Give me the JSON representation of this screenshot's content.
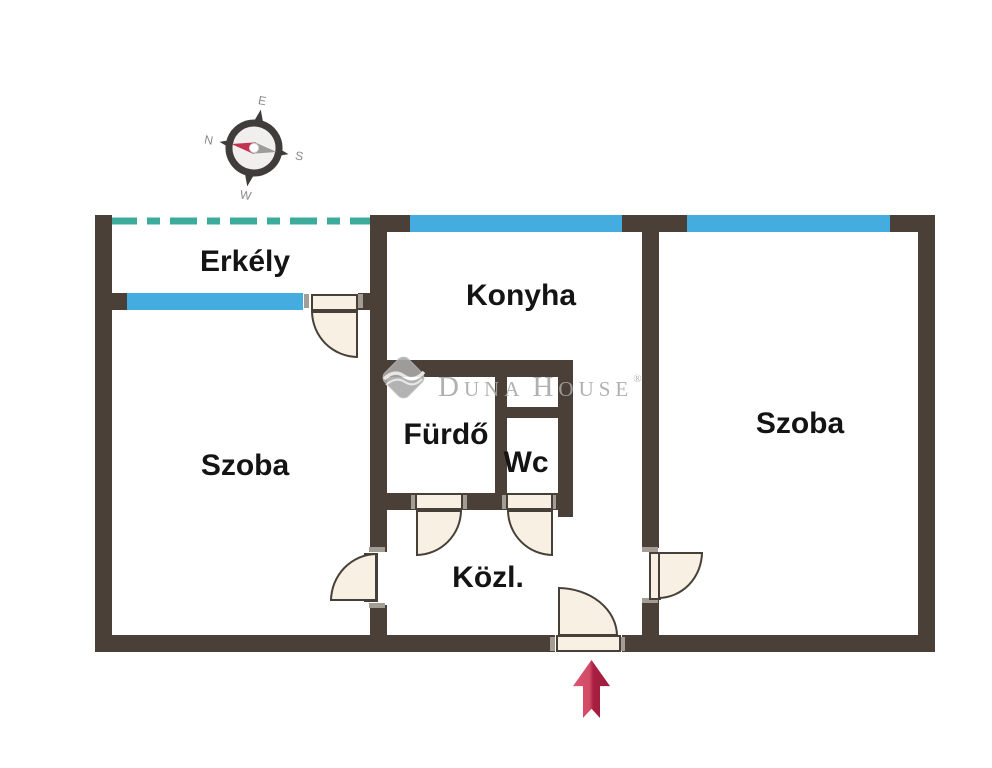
{
  "floorplan": {
    "rooms": {
      "erkely": {
        "label": "Erkély"
      },
      "konyha": {
        "label": "Konyha"
      },
      "szoba_left": {
        "label": "Szoba"
      },
      "szoba_right": {
        "label": "Szoba"
      },
      "furdo": {
        "label": "Fürdő"
      },
      "wc": {
        "label": "Wc"
      },
      "kozl": {
        "label": "Közl."
      }
    },
    "compass": {
      "n": "N",
      "e": "E",
      "s": "S",
      "w": "W"
    },
    "watermark": {
      "d": "D",
      "una": "UNA",
      "h": "H",
      "ouse": "OUSE",
      "registered": "®"
    },
    "colors": {
      "wall": "#4a4037",
      "window": "#45ace0",
      "door": "#f8f1e3",
      "balcony_dashed_line": "#3cab9b",
      "entrance_arrow_light": "#db5672",
      "entrance_arrow_dark": "#a91f42",
      "watermark_gray": "#a6a6a6",
      "compass_needle_red": "#c13350",
      "compass_needle_gray": "#9c9c9c"
    },
    "icons": {
      "compass": "compass-rose-icon",
      "entrance": "arrow-up-icon",
      "brand": "duna-house-diamond-icon"
    }
  }
}
